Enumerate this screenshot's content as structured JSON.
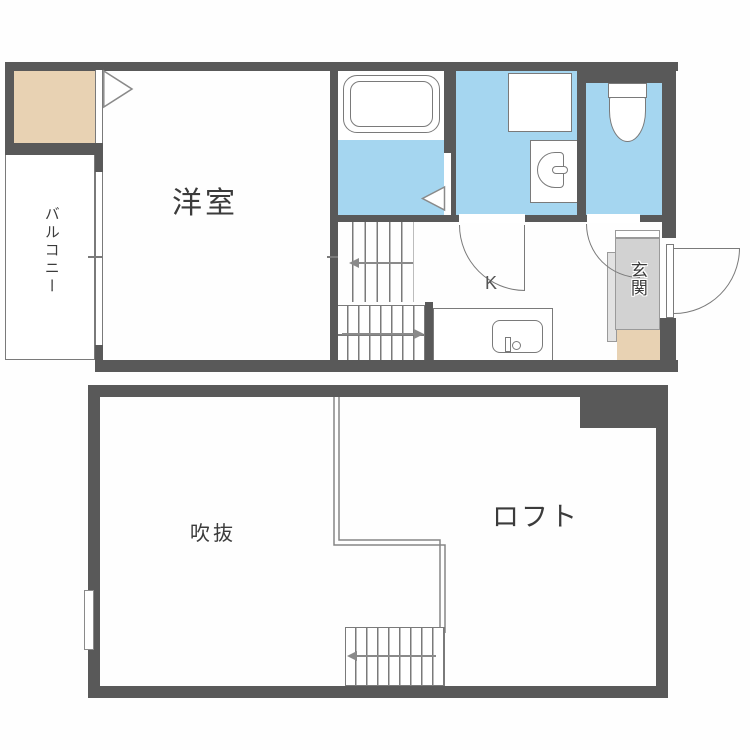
{
  "upper_floor": {
    "western_room_label": "洋室",
    "balcony_label": "バルコニー",
    "kitchen_label": "K",
    "entrance_label": "玄関"
  },
  "lower_floor": {
    "void_label": "吹抜",
    "loft_label": "ロフト"
  },
  "colors": {
    "wall_gray": "#595959",
    "wet_area_blue": "#a5d6f0",
    "closet_tan": "#e8d2b3",
    "entrance_floor_gray": "#d2d2d2",
    "fixture_line_gray": "#7a7a7a"
  }
}
